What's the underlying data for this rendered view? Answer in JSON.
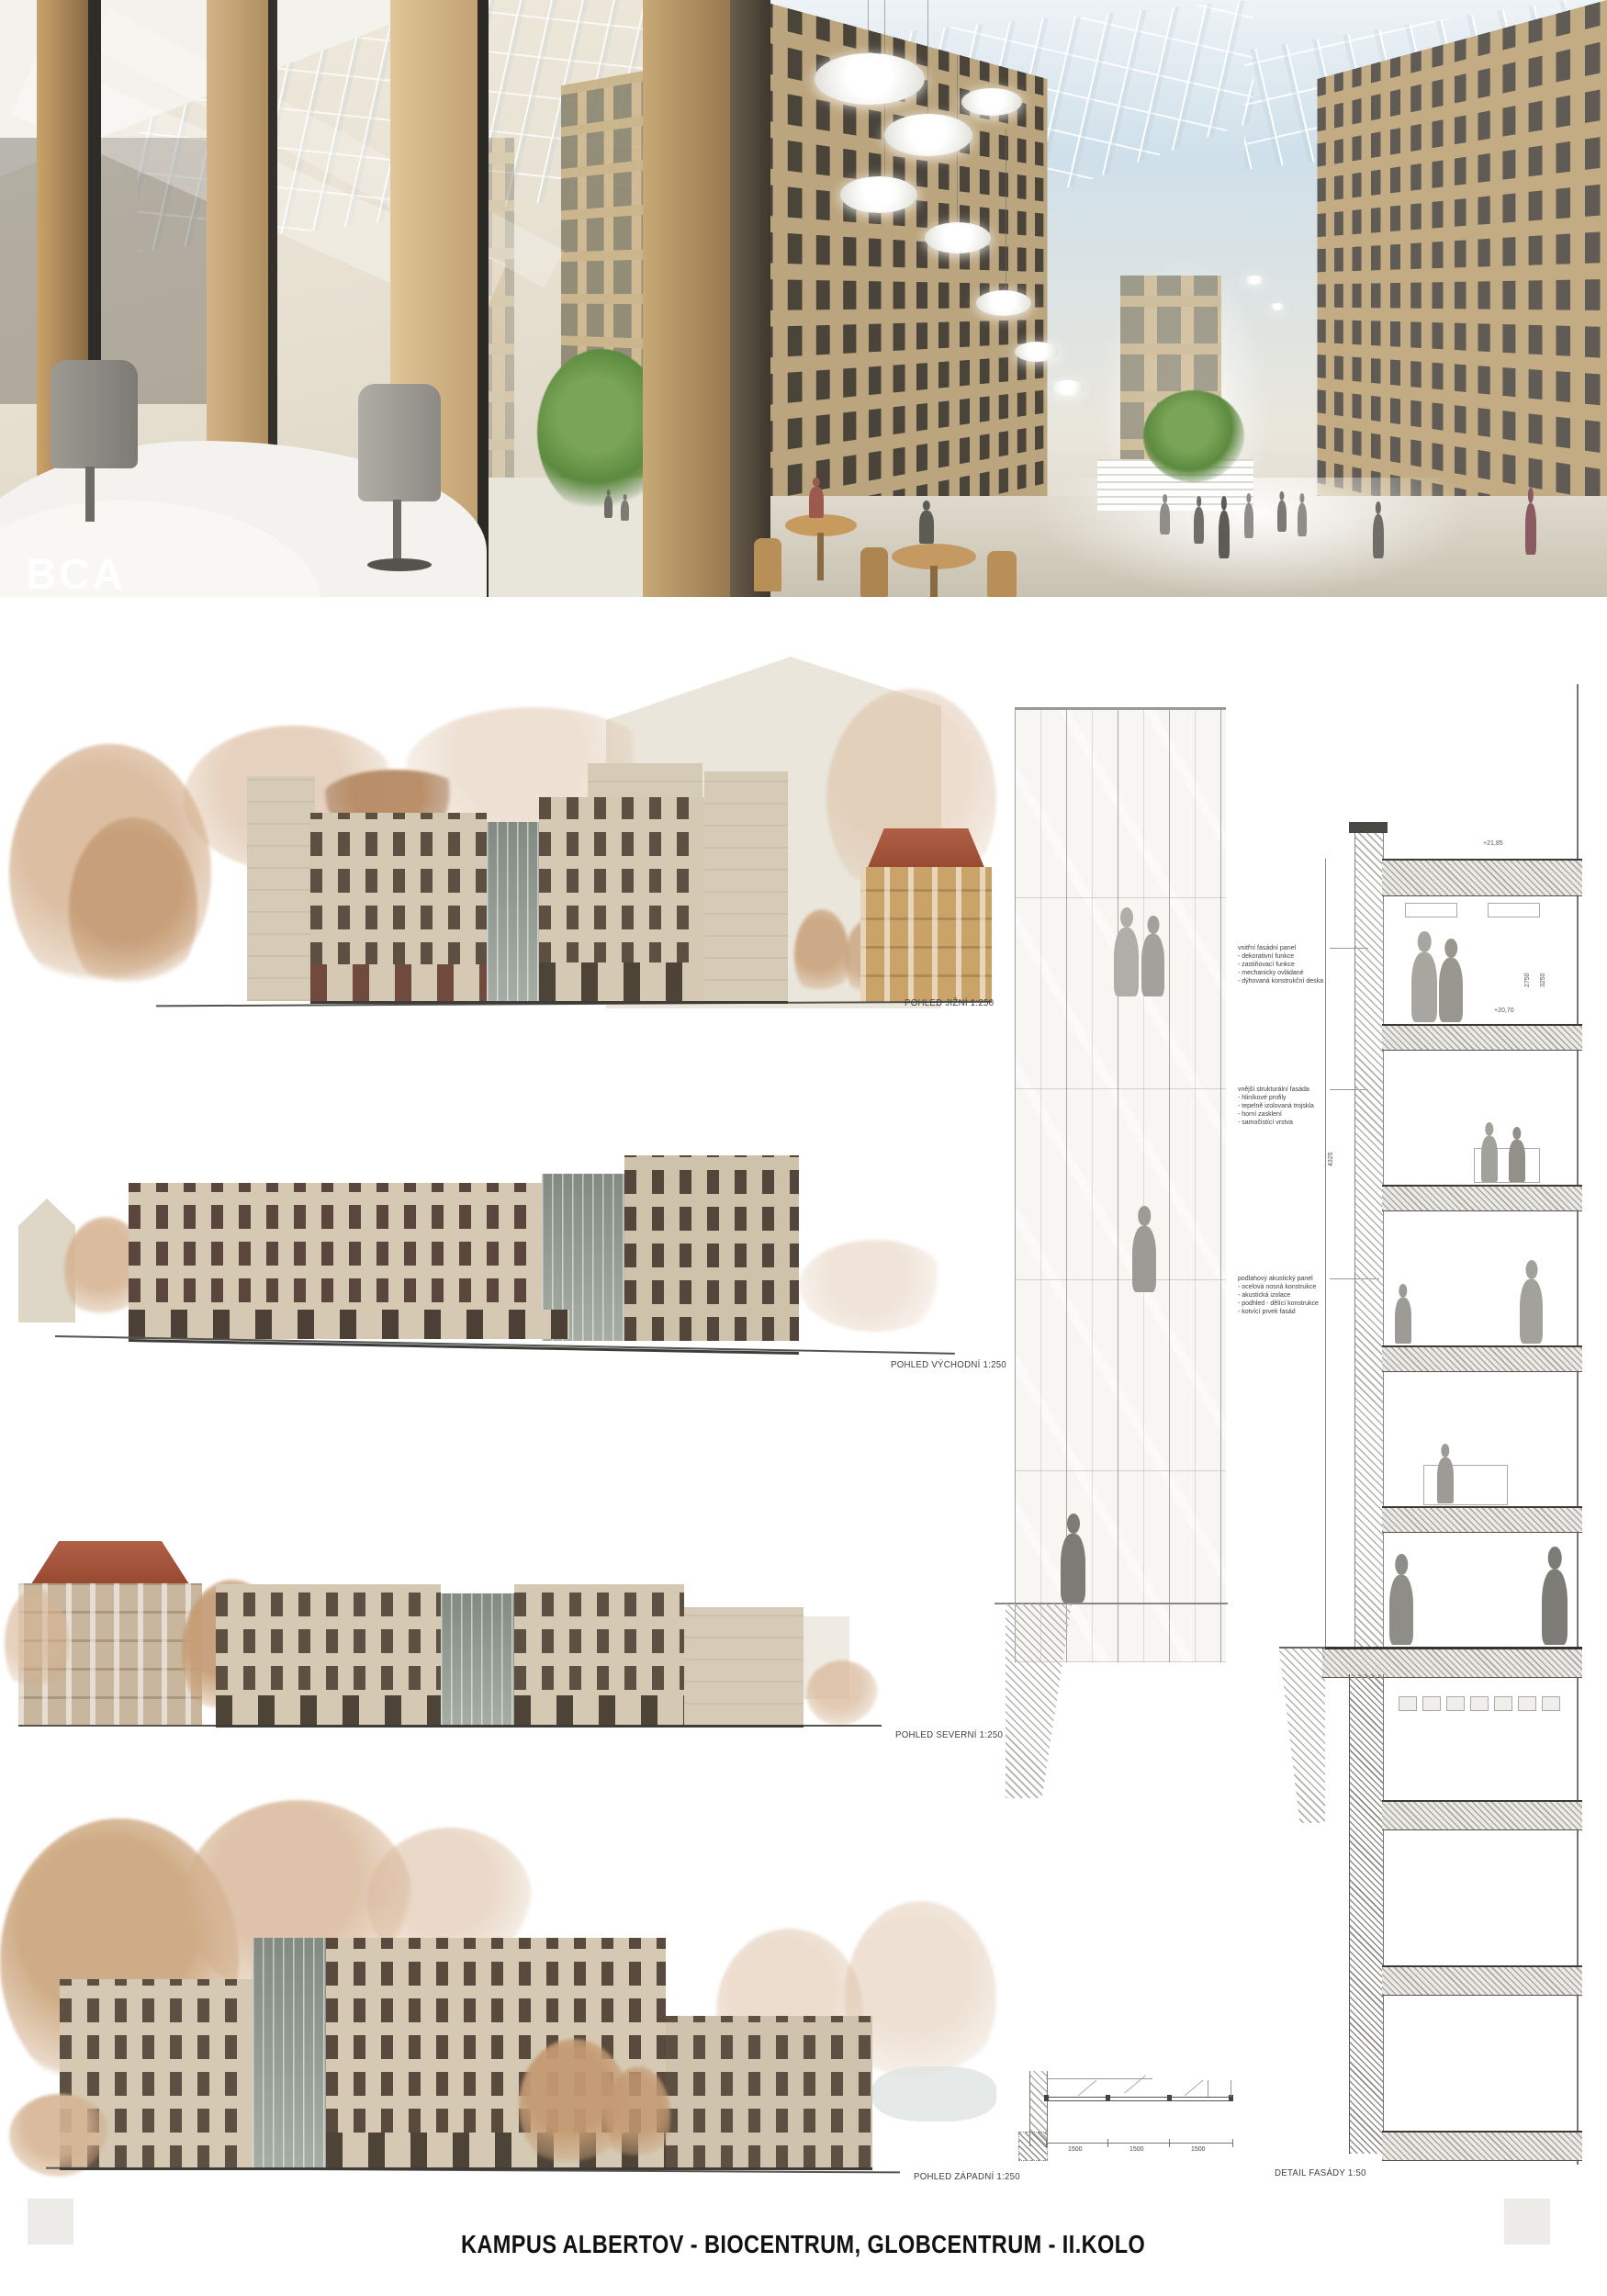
{
  "board": {
    "footer_title": "KAMPUS ALBERTOV - BIOCENTRUM, GLOBCENTRUM - II.KOLO"
  },
  "hero": {
    "logo": "BCA"
  },
  "elevations": [
    {
      "label": "POHLED JIŽNÍ 1:250"
    },
    {
      "label": "POHLED VÝCHODNÍ 1:250"
    },
    {
      "label": "POHLED SEVERNÍ 1:250"
    },
    {
      "label": "POHLED ZÁPADNÍ 1:250"
    }
  ],
  "facade_detail": {
    "label": "DETAIL FASÁDY 1:50",
    "annotations": [
      {
        "title": "vnitřní fasádní panel",
        "items": [
          "- dekorativní funkce",
          "- zastiňovací funkce",
          "- mechanicky ovládané",
          "- dýhovaná konstrukční deska"
        ]
      },
      {
        "title": "vnější strukturální fasáda",
        "items": [
          "- hliníkové profily",
          "- tepelně izolovaná trojskla",
          "- horní zasklení",
          "- samočistící vrstva"
        ]
      },
      {
        "title": "podlahový akustický panel",
        "items": [
          "- ocelová nosná konstrukce",
          "- akustická izolace",
          "- podhled - dělící konstrukce",
          "- kotvící prvek fasád"
        ]
      }
    ],
    "levels": [
      "+21,85",
      "+20,70"
    ],
    "dims": [
      "4325",
      "2750",
      "3250"
    ],
    "plan_dims": [
      "1500",
      "1500",
      "1500"
    ]
  },
  "colors": {
    "facade_tan": "#bfa87f",
    "window_dark": "#5d4f41",
    "roof_terracotta": "#a2543e",
    "tree_sepia": "#c9a47e",
    "tree_green": "#5f8c43",
    "accent_red_brown": "#7a4338"
  }
}
